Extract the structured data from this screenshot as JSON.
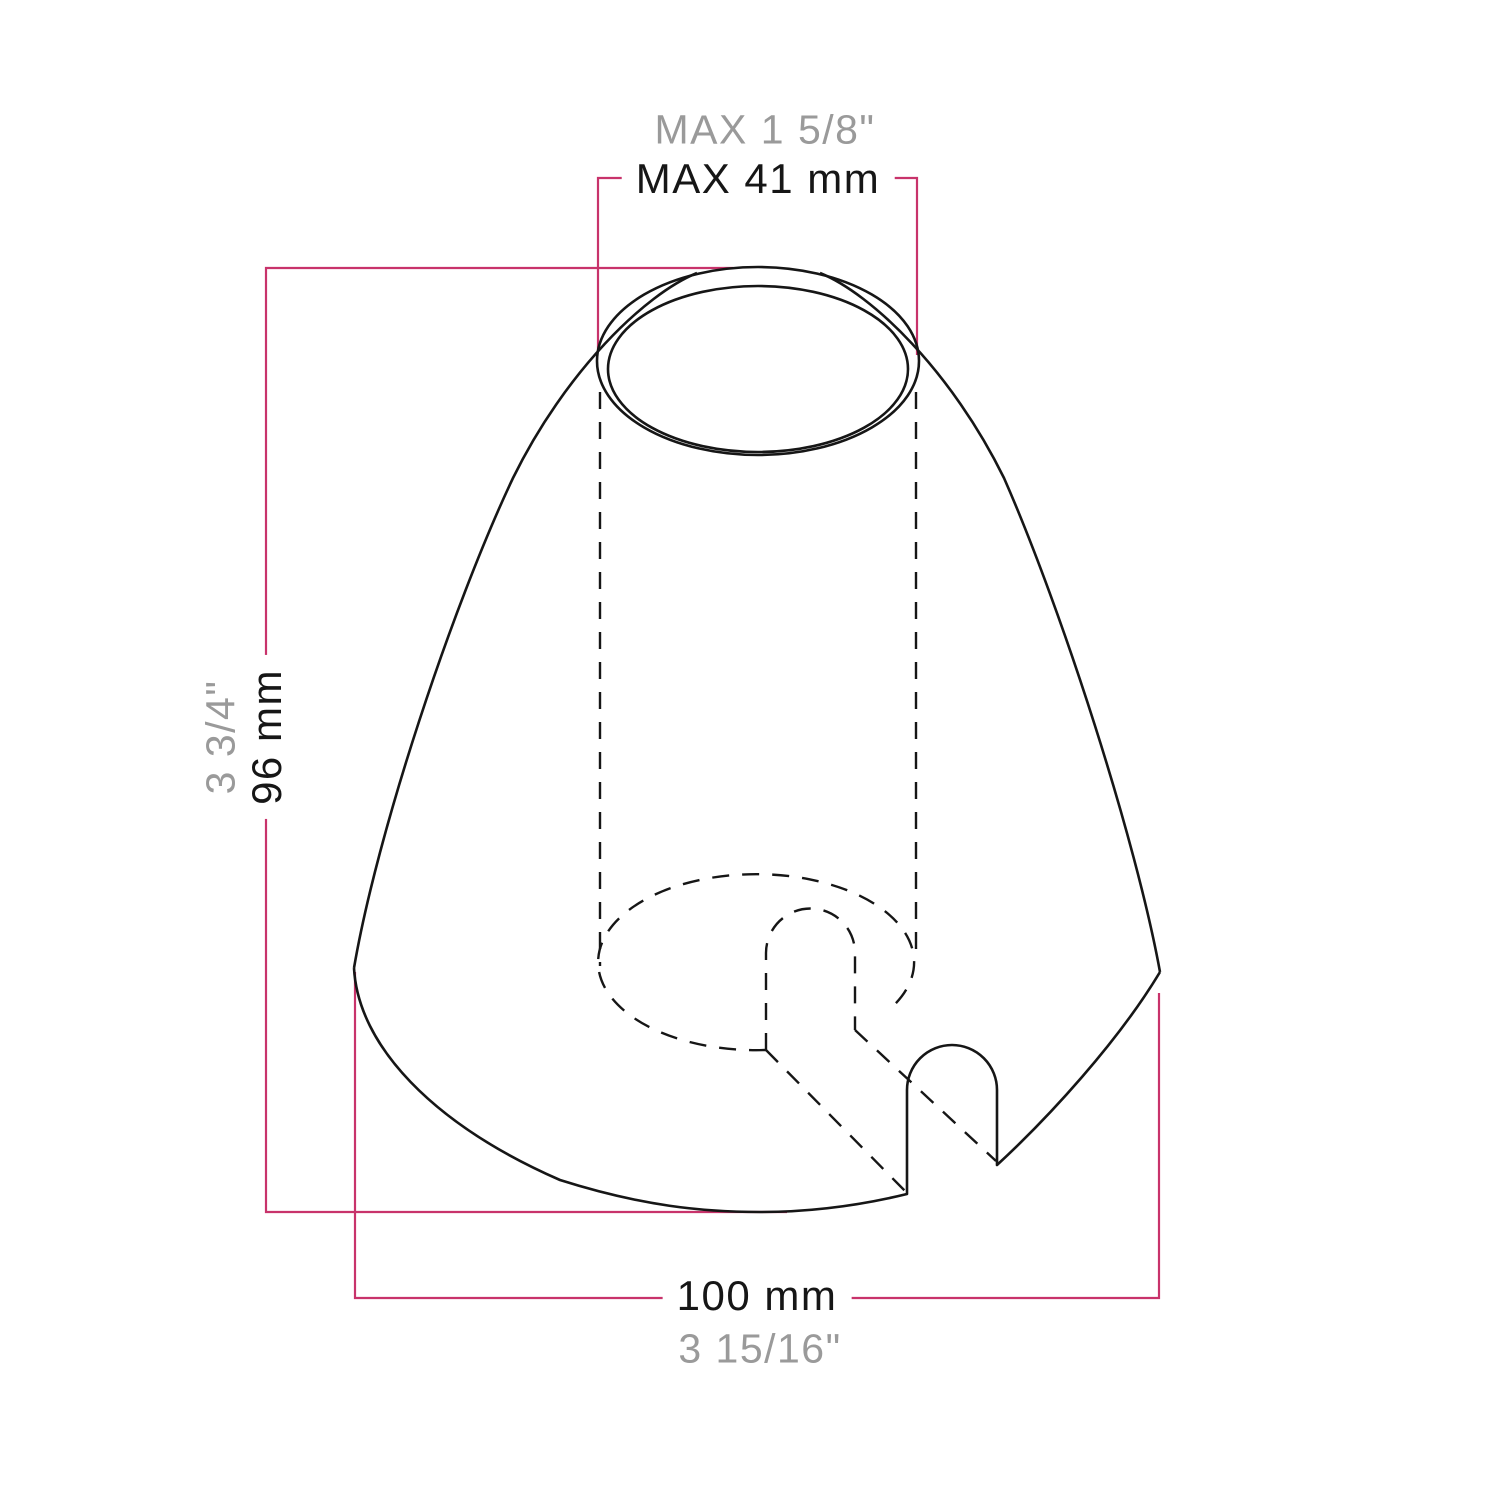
{
  "diagram": {
    "title": "Cone lamp holder cover dimension drawing",
    "labels": {
      "top_width_imperial": "MAX 1 5/8\"",
      "top_width_metric": "MAX 41 mm",
      "height_imperial": "3 3/4\"",
      "height_metric": "96 mm",
      "base_width_metric": "100 mm",
      "base_width_imperial": "3 15/16\""
    },
    "measurements": {
      "top_opening_max_mm": 41,
      "height_mm": 96,
      "base_diameter_mm": 100
    }
  },
  "colors": {
    "dimension_line": "#c8336b",
    "outline": "#161616",
    "metric_text": "#161616",
    "imperial_text": "#9a9a9a",
    "background": "#ffffff"
  }
}
